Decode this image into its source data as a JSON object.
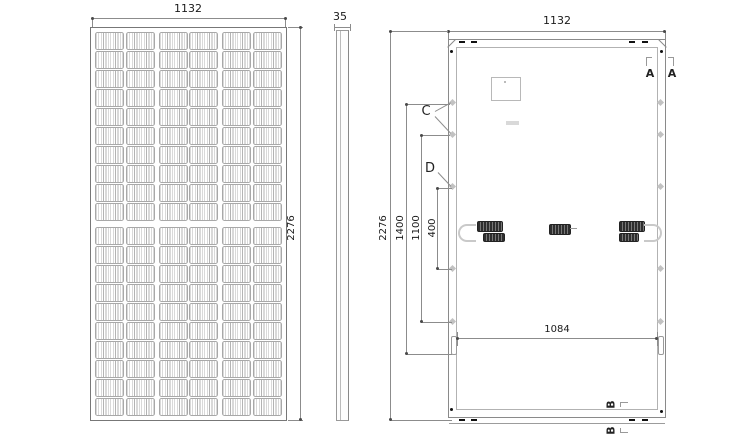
{
  "front_view": {
    "top_dim": "1132",
    "right_dim": "2276",
    "grid": {
      "rows": 20,
      "cols": 6,
      "half_rows": 10
    }
  },
  "side_view": {
    "top_dim": "35"
  },
  "back_view": {
    "top_dim": "1132",
    "left_dims": [
      {
        "label": "2276"
      },
      {
        "label": "1400"
      },
      {
        "label": "1100"
      },
      {
        "label": "400"
      }
    ],
    "bottom_dim": "1084",
    "sections": {
      "a_left": "A",
      "a_right": "A",
      "b_top": "B",
      "b_bottom": "B",
      "c": "C",
      "d": "D"
    }
  },
  "colors": {
    "line": "#8c8c8c",
    "frame": "#777777",
    "cell_hatch": "#b3b3b3",
    "connector_dark": "#2e2e2e",
    "slot_black": "#111111",
    "text": "#1a1a1a"
  }
}
